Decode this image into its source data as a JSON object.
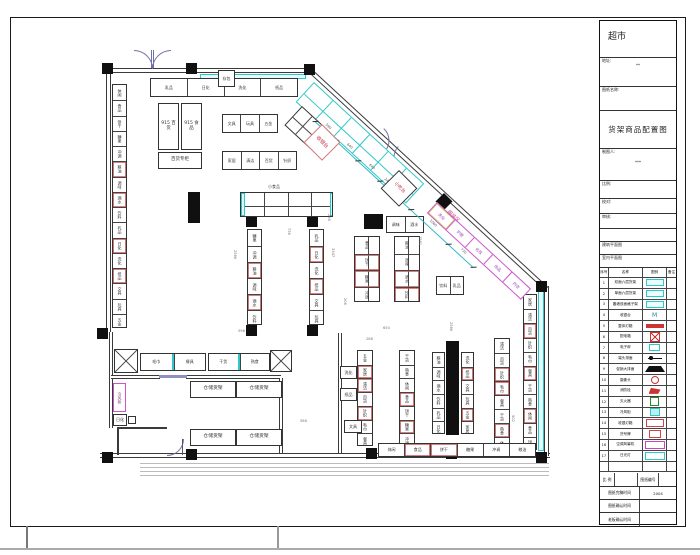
{
  "title_block": {
    "project": "超市",
    "address_label": "地址:",
    "address_value": "**",
    "drawing_name_label": "图纸名称:",
    "drawing_title": "货架商品配置图",
    "drafter_label": "制图人:",
    "drafter_value": "***",
    "scale_label": "比例:",
    "check_label": "校对:",
    "audit_label": "审核:",
    "arch_plan": "建筑平面图",
    "interior_plan": "室内平面图",
    "legend": {
      "headers": [
        "序号",
        "名称",
        "图例",
        "备注"
      ],
      "rows": [
        {
          "no": "1",
          "name": "双面六层货架",
          "sym": "shelfcyan"
        },
        {
          "no": "2",
          "name": "单面六层货架",
          "sym": "shelfcyan"
        },
        {
          "no": "3",
          "name": "靠墙双面格子架",
          "sym": "shelfcyan"
        },
        {
          "no": "4",
          "name": "收银台",
          "sym": "mtext"
        },
        {
          "no": "5",
          "name": "整体灯箱",
          "sym": "redbar"
        },
        {
          "no": "6",
          "name": "配电箱",
          "sym": "redx"
        },
        {
          "no": "7",
          "name": "电子秤",
          "sym": "cyansmall"
        },
        {
          "no": "8",
          "name": "端头排面",
          "sym": "dotline"
        },
        {
          "no": "9",
          "name": "促销大排面",
          "sym": "trap"
        },
        {
          "no": "10",
          "name": "摄像头",
          "sym": "redring"
        },
        {
          "no": "11",
          "name": "消防栓",
          "sym": "redflag"
        },
        {
          "no": "12",
          "name": "灭火器",
          "sym": "greenbox"
        },
        {
          "no": "13",
          "name": "冷风柜",
          "sym": "cyanfill"
        },
        {
          "no": "14",
          "name": "收银灯箱",
          "sym": "redboxtext"
        },
        {
          "no": "15",
          "name": "货号牌",
          "sym": "redsmall"
        },
        {
          "no": "16",
          "name": "空调风幕机",
          "sym": "magbox"
        },
        {
          "no": "17",
          "name": "日光灯",
          "sym": "cyanbox"
        },
        {
          "no": "",
          "name": "",
          "sym": "none"
        }
      ]
    },
    "footer": {
      "scale_label": "比 例",
      "drawing_no_label": "图纸编号",
      "done_label": "图纸完稿时间",
      "done_value": "2004",
      "confirm_label": "图纸确认时间",
      "confirm_value": "",
      "boss_label": "老板确认时间",
      "boss_value": ""
    }
  },
  "plan": {
    "storage_label": "仓储货架",
    "checkout_label": "收银台",
    "snack_label": "小吃台",
    "clothing_label": "服装区",
    "locker_label": "存包",
    "shelf_labels": [
      "休闲",
      "食品",
      "饼干",
      "糖果",
      "冲调",
      "粮油",
      "调味",
      "酒水",
      "饮料",
      "乳品",
      "日化",
      "洗化",
      "纸品",
      "文具",
      "玩具",
      "五金",
      "家居",
      "清洁",
      "百货",
      "针织",
      "毛巾",
      "餐具",
      "干货",
      "熟食"
    ],
    "m_labels": [
      "洗化",
      "护肤",
      "化妆",
      "饰品",
      "内衣"
    ],
    "diag_dims": [
      "590",
      "640",
      "640",
      "240",
      "650",
      "1060",
      "730"
    ],
    "items": [
      {
        "t": "wall",
        "o": "h",
        "x": 108,
        "y": 68,
        "w": 206,
        "h": 5
      },
      {
        "t": "wall",
        "o": "v",
        "x": 106,
        "y": 70,
        "w": 5,
        "h": 262
      },
      {
        "t": "wall",
        "o": "v",
        "x": 109,
        "y": 332,
        "w": 4,
        "h": 96
      },
      {
        "t": "wall",
        "o": "h",
        "x": 111,
        "y": 375,
        "w": 49,
        "h": 4
      },
      {
        "t": "wall",
        "o": "h",
        "x": 186,
        "y": 375,
        "w": 95,
        "h": 4
      },
      {
        "t": "fill",
        "x": 159,
        "y": 375,
        "w": 28,
        "h": 3,
        "c": "#9090c0",
        "nm": "door-threshold"
      },
      {
        "t": "wall",
        "o": "v",
        "x": 279,
        "y": 378,
        "w": 4,
        "h": 78
      },
      {
        "t": "wall",
        "o": "v",
        "x": 338,
        "y": 333,
        "w": 4,
        "h": 123
      },
      {
        "t": "wall",
        "o": "h",
        "x": 100,
        "y": 453,
        "w": 450,
        "h": 5
      },
      {
        "t": "wall",
        "o": "v",
        "x": 544,
        "y": 286,
        "w": 5,
        "h": 170
      },
      {
        "t": "wall",
        "o": "h",
        "x": 312,
        "y": 69,
        "w": 322,
        "h": 5,
        "r": 42.7,
        "nm": "diagonal-wall"
      },
      {
        "t": "cyan",
        "x": 200,
        "y": 74,
        "w": 106,
        "h": 5
      },
      {
        "t": "cyan",
        "x": 538,
        "y": 290,
        "w": 6,
        "h": 161
      },
      {
        "t": "hatch",
        "x": 140,
        "y": 463,
        "w": 409,
        "h": 13
      },
      {
        "t": "wall",
        "o": "h",
        "x": 117,
        "y": 427,
        "w": 50,
        "h": 2
      },
      {
        "t": "wall",
        "o": "v",
        "x": 117,
        "y": 429,
        "w": 2,
        "h": 26
      },
      {
        "t": "arc",
        "x": 167,
        "y": 439,
        "s": 16,
        "cor": "br"
      },
      {
        "t": "fill",
        "x": 182,
        "y": 439,
        "w": 1,
        "h": 16,
        "c": "#556"
      },
      {
        "t": "arc",
        "x": 134,
        "y": 50,
        "s": 18,
        "cor": "tr"
      },
      {
        "t": "arc",
        "x": 152,
        "y": 50,
        "s": 18,
        "cor": "tl"
      },
      {
        "t": "fill",
        "x": 151,
        "y": 50,
        "w": 1,
        "h": 18,
        "c": "#7070a8"
      },
      {
        "t": "fill",
        "x": 153,
        "y": 50,
        "w": 1,
        "h": 18,
        "c": "#7070a8"
      },
      {
        "t": "arc",
        "x": 384,
        "y": 128,
        "s": 16,
        "cor": "tr",
        "r": 42.7
      },
      {
        "t": "arc",
        "x": 398,
        "y": 146,
        "s": 16,
        "cor": "bl",
        "r": 42.7
      },
      {
        "t": "fill",
        "x": 102,
        "y": 63,
        "w": 11,
        "h": 11
      },
      {
        "t": "fill",
        "x": 186,
        "y": 63,
        "w": 11,
        "h": 11
      },
      {
        "t": "fill",
        "x": 304,
        "y": 64,
        "w": 11,
        "h": 11
      },
      {
        "t": "fill",
        "x": 97,
        "y": 328,
        "w": 11,
        "h": 11
      },
      {
        "t": "fill",
        "x": 246,
        "y": 216,
        "w": 11,
        "h": 11
      },
      {
        "t": "fill",
        "x": 307,
        "y": 216,
        "w": 11,
        "h": 11
      },
      {
        "t": "fill",
        "x": 364,
        "y": 214,
        "w": 19,
        "h": 15,
        "nm": "end-platform"
      },
      {
        "t": "fill",
        "x": 536,
        "y": 281,
        "w": 11,
        "h": 11
      },
      {
        "t": "fill",
        "x": 246,
        "y": 325,
        "w": 11,
        "h": 11
      },
      {
        "t": "fill",
        "x": 307,
        "y": 325,
        "w": 11,
        "h": 11
      },
      {
        "t": "fill",
        "x": 102,
        "y": 452,
        "w": 11,
        "h": 11
      },
      {
        "t": "fill",
        "x": 186,
        "y": 449,
        "w": 11,
        "h": 11
      },
      {
        "t": "fill",
        "x": 366,
        "y": 448,
        "w": 11,
        "h": 11
      },
      {
        "t": "fill",
        "x": 446,
        "y": 448,
        "w": 11,
        "h": 11
      },
      {
        "t": "fill",
        "x": 536,
        "y": 452,
        "w": 11,
        "h": 11
      },
      {
        "t": "fill",
        "x": 444,
        "y": 193,
        "w": 12,
        "h": 12,
        "r": 45,
        "nm": "diamond-column"
      },
      {
        "t": "fill",
        "x": 188,
        "y": 192,
        "w": 12,
        "h": 31,
        "nm": "black-bar"
      },
      {
        "t": "fill",
        "x": 446,
        "y": 341,
        "w": 13,
        "h": 94,
        "nm": "black-bar"
      },
      {
        "t": "run",
        "x": 112,
        "y": 84,
        "w": 15,
        "h": 244,
        "n": 16,
        "red": [
          5,
          7,
          10,
          12
        ],
        "cap": 1
      },
      {
        "t": "run",
        "x": 523,
        "y": 294,
        "w": 14,
        "h": 156,
        "n": 11,
        "red": [
          2,
          5,
          8
        ],
        "cap": 1
      },
      {
        "t": "run",
        "x": 247,
        "y": 229,
        "w": 15,
        "h": 96,
        "n": 6,
        "red": [
          2,
          4
        ],
        "cap": 0
      },
      {
        "t": "run",
        "x": 309,
        "y": 229,
        "w": 15,
        "h": 96,
        "n": 6,
        "red": [
          1,
          3
        ],
        "cap": 0
      },
      {
        "t": "run",
        "x": 357,
        "y": 350,
        "w": 16,
        "h": 96,
        "n": 7,
        "red": [
          1,
          2,
          4
        ],
        "cap": 1
      },
      {
        "t": "run",
        "x": 399,
        "y": 350,
        "w": 16,
        "h": 96,
        "n": 7,
        "red": [
          3,
          5
        ],
        "cap": 1
      },
      {
        "t": "run",
        "x": 432,
        "y": 352,
        "w": 13,
        "h": 82,
        "n": 6,
        "red": [],
        "cap": 0
      },
      {
        "t": "run",
        "x": 461,
        "y": 352,
        "w": 13,
        "h": 82,
        "n": 6,
        "red": [
          1,
          4
        ],
        "cap": 0
      },
      {
        "t": "run",
        "x": 494,
        "y": 338,
        "w": 16,
        "h": 112,
        "n": 8,
        "red": [
          2,
          3,
          6
        ],
        "cap": 1
      },
      {
        "t": "vd",
        "x": 354,
        "y": 236,
        "w": 26,
        "h": 66,
        "n": 4,
        "red": [
          1,
          2
        ],
        "cap": 1
      },
      {
        "t": "vd",
        "x": 394,
        "y": 236,
        "w": 26,
        "h": 66,
        "n": 4,
        "red": [
          2,
          3
        ],
        "cap": 1
      },
      {
        "t": "row",
        "x": 150,
        "y": 78,
        "w": 148,
        "h": 19,
        "n": 4
      },
      {
        "t": "row",
        "x": 222,
        "y": 114,
        "w": 56,
        "h": 19,
        "n": 3
      },
      {
        "t": "row",
        "x": 222,
        "y": 151,
        "w": 75,
        "h": 19,
        "n": 4
      },
      {
        "t": "row",
        "x": 140,
        "y": 353,
        "w": 66,
        "h": 18,
        "n": 2,
        "cap": 1
      },
      {
        "t": "row",
        "x": 208,
        "y": 353,
        "w": 62,
        "h": 18,
        "n": 2,
        "cap": 1
      },
      {
        "t": "row",
        "x": 378,
        "y": 443,
        "w": 158,
        "h": 14,
        "n": 6,
        "red": [
          1,
          2
        ]
      },
      {
        "t": "row",
        "x": 386,
        "y": 216,
        "w": 38,
        "h": 17,
        "n": 2
      },
      {
        "t": "row",
        "x": 436,
        "y": 276,
        "w": 28,
        "h": 19,
        "n": 2
      },
      {
        "t": "grid",
        "x": 240,
        "y": 192,
        "w": 93,
        "h": 25,
        "rows": 2,
        "cols": 4,
        "cap": 1
      },
      {
        "t": "grid",
        "x": 314,
        "y": 82,
        "w": 150,
        "h": 27,
        "rows": 2,
        "cols": 6,
        "r": 42.7,
        "bc": "#2ec8c8"
      },
      {
        "t": "grid",
        "x": 302,
        "y": 106,
        "w": 40,
        "h": 26,
        "rows": 2,
        "cols": 3,
        "r": 42.7
      },
      {
        "t": "mrun",
        "x": 437,
        "y": 202,
        "w": 128,
        "h": 15,
        "r": 42.7,
        "cells": 5
      },
      {
        "t": "dim",
        "x": 320,
        "y": 116,
        "w": 215,
        "r": 42.7
      },
      {
        "t": "box",
        "x": 158,
        "y": 103,
        "w": 21,
        "h": 47,
        "lbl": "915 百货",
        "ls": 4.5
      },
      {
        "t": "box",
        "x": 181,
        "y": 103,
        "w": 21,
        "h": 47,
        "lbl": "915 食品",
        "ls": 4.5
      },
      {
        "t": "box",
        "x": 158,
        "y": 152,
        "w": 44,
        "h": 17,
        "lbl": "百货专柜",
        "ls": 4.5
      },
      {
        "t": "box",
        "x": 218,
        "y": 70,
        "w": 17,
        "h": 17,
        "lbl": "存包",
        "ls": 4
      },
      {
        "t": "box",
        "x": 399,
        "y": 170,
        "w": 26,
        "h": 26,
        "r": 45,
        "lbl": "小吃台",
        "lc": "#bb3344",
        "ls": 4.5,
        "nm": "snack-counter"
      },
      {
        "t": "box",
        "x": 322,
        "y": 124,
        "w": 26,
        "h": 26,
        "r": 45,
        "lbl": "收银台",
        "lc": "#bb3344",
        "ls": 5,
        "bc": "#cc7777",
        "nm": "checkout-counter"
      },
      {
        "t": "box",
        "x": 190,
        "y": 381,
        "w": 46,
        "h": 17,
        "lbl": "仓储货架",
        "ls": 4.8,
        "nm": "storage-shelf"
      },
      {
        "t": "box",
        "x": 236,
        "y": 381,
        "w": 46,
        "h": 17,
        "lbl": "仓储货架",
        "ls": 4.8,
        "nm": "storage-shelf"
      },
      {
        "t": "box",
        "x": 190,
        "y": 429,
        "w": 46,
        "h": 17,
        "lbl": "仓储货架",
        "ls": 4.8,
        "nm": "storage-shelf"
      },
      {
        "t": "box",
        "x": 236,
        "y": 429,
        "w": 46,
        "h": 17,
        "lbl": "仓储货架",
        "ls": 4.8,
        "nm": "storage-shelf"
      },
      {
        "t": "box",
        "x": 113,
        "y": 383,
        "w": 13,
        "h": 29,
        "bc": "#cc55cc",
        "v": 1,
        "lbl": "冷风柜",
        "lc": "#884488",
        "ls": 4
      },
      {
        "t": "box",
        "x": 113,
        "y": 414,
        "w": 14,
        "h": 12,
        "lbl": "@",
        "ls": 4
      },
      {
        "t": "box",
        "x": 128,
        "y": 416,
        "w": 8,
        "h": 8
      },
      {
        "t": "box",
        "x": 340,
        "y": 366,
        "w": 17,
        "h": 13,
        "lbl": "@",
        "ls": 4
      },
      {
        "t": "box",
        "x": 340,
        "y": 388,
        "w": 17,
        "h": 13,
        "lbl": "@",
        "ls": 4
      },
      {
        "t": "box",
        "x": 344,
        "y": 420,
        "w": 18,
        "h": 13,
        "lbl": "@",
        "ls": 4
      },
      {
        "t": "x",
        "x": 114,
        "y": 349,
        "w": 24,
        "h": 24
      },
      {
        "t": "x",
        "x": 270,
        "y": 350,
        "w": 22,
        "h": 22
      },
      {
        "t": "txt",
        "x": 449,
        "y": 210,
        "tx": "服装区",
        "c": "#cc44aa",
        "r": 42.7,
        "s": 5
      },
      {
        "t": "txt",
        "x": 268,
        "y": 185,
        "tx": "小食品",
        "c": "#444",
        "s": 4
      },
      {
        "t": "txt",
        "x": 236,
        "y": 250,
        "tx": "2586",
        "r": 90
      },
      {
        "t": "txt",
        "x": 334,
        "y": 248,
        "tx": "3347",
        "r": 90
      },
      {
        "t": "txt",
        "x": 330,
        "y": 214,
        "tx": "296",
        "r": 90
      },
      {
        "t": "txt",
        "x": 383,
        "y": 327,
        "tx": "650"
      },
      {
        "t": "txt",
        "x": 346,
        "y": 298,
        "tx": "206",
        "r": 90
      },
      {
        "t": "txt",
        "x": 514,
        "y": 415,
        "tx": "902",
        "r": 90
      },
      {
        "t": "txt",
        "x": 300,
        "y": 420,
        "tx": "586"
      },
      {
        "t": "txt",
        "x": 452,
        "y": 322,
        "tx": "2586",
        "r": 90
      },
      {
        "t": "txt",
        "x": 290,
        "y": 228,
        "tx": "736",
        "r": 90
      },
      {
        "t": "txt",
        "x": 421,
        "y": 236,
        "tx": "1581",
        "r": 90
      },
      {
        "t": "txt",
        "x": 238,
        "y": 330,
        "tx": "596"
      },
      {
        "t": "txt",
        "x": 366,
        "y": 338,
        "tx": "286"
      }
    ]
  }
}
